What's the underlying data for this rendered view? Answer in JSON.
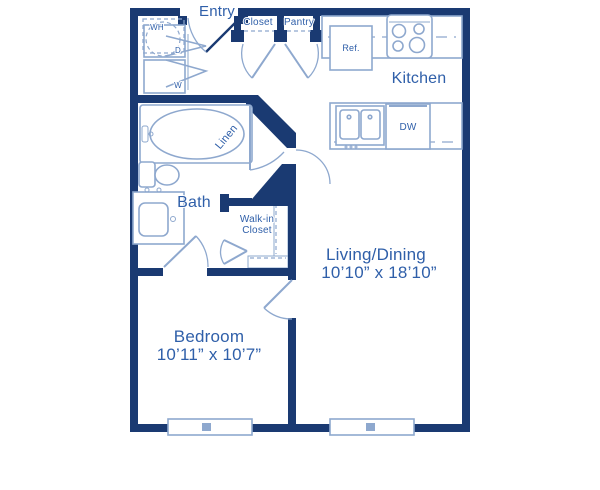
{
  "colors": {
    "wall": "#1a3a72",
    "fixture": "#8ea8ce",
    "text": "#2f5fa9"
  },
  "floorplan": {
    "entry_label": "Entry",
    "rooms": {
      "kitchen": {
        "name": "Kitchen"
      },
      "bath": {
        "name": "Bath"
      },
      "living": {
        "name": "Living/Dining",
        "dims": "10’10” x 18’10”"
      },
      "bedroom": {
        "name": "Bedroom",
        "dims": "10’11” x 10’7”"
      },
      "walkin": {
        "name_line1": "Walk-in",
        "name_line2": "Closet"
      },
      "closet": {
        "name": "Closet"
      },
      "pantry": {
        "name": "Pantry"
      },
      "linen": {
        "name": "Linen"
      }
    },
    "fixtures": {
      "refrigerator": "Ref.",
      "dishwasher": "DW",
      "water_heater": "WH",
      "dryer": "D",
      "washer": "W"
    }
  }
}
